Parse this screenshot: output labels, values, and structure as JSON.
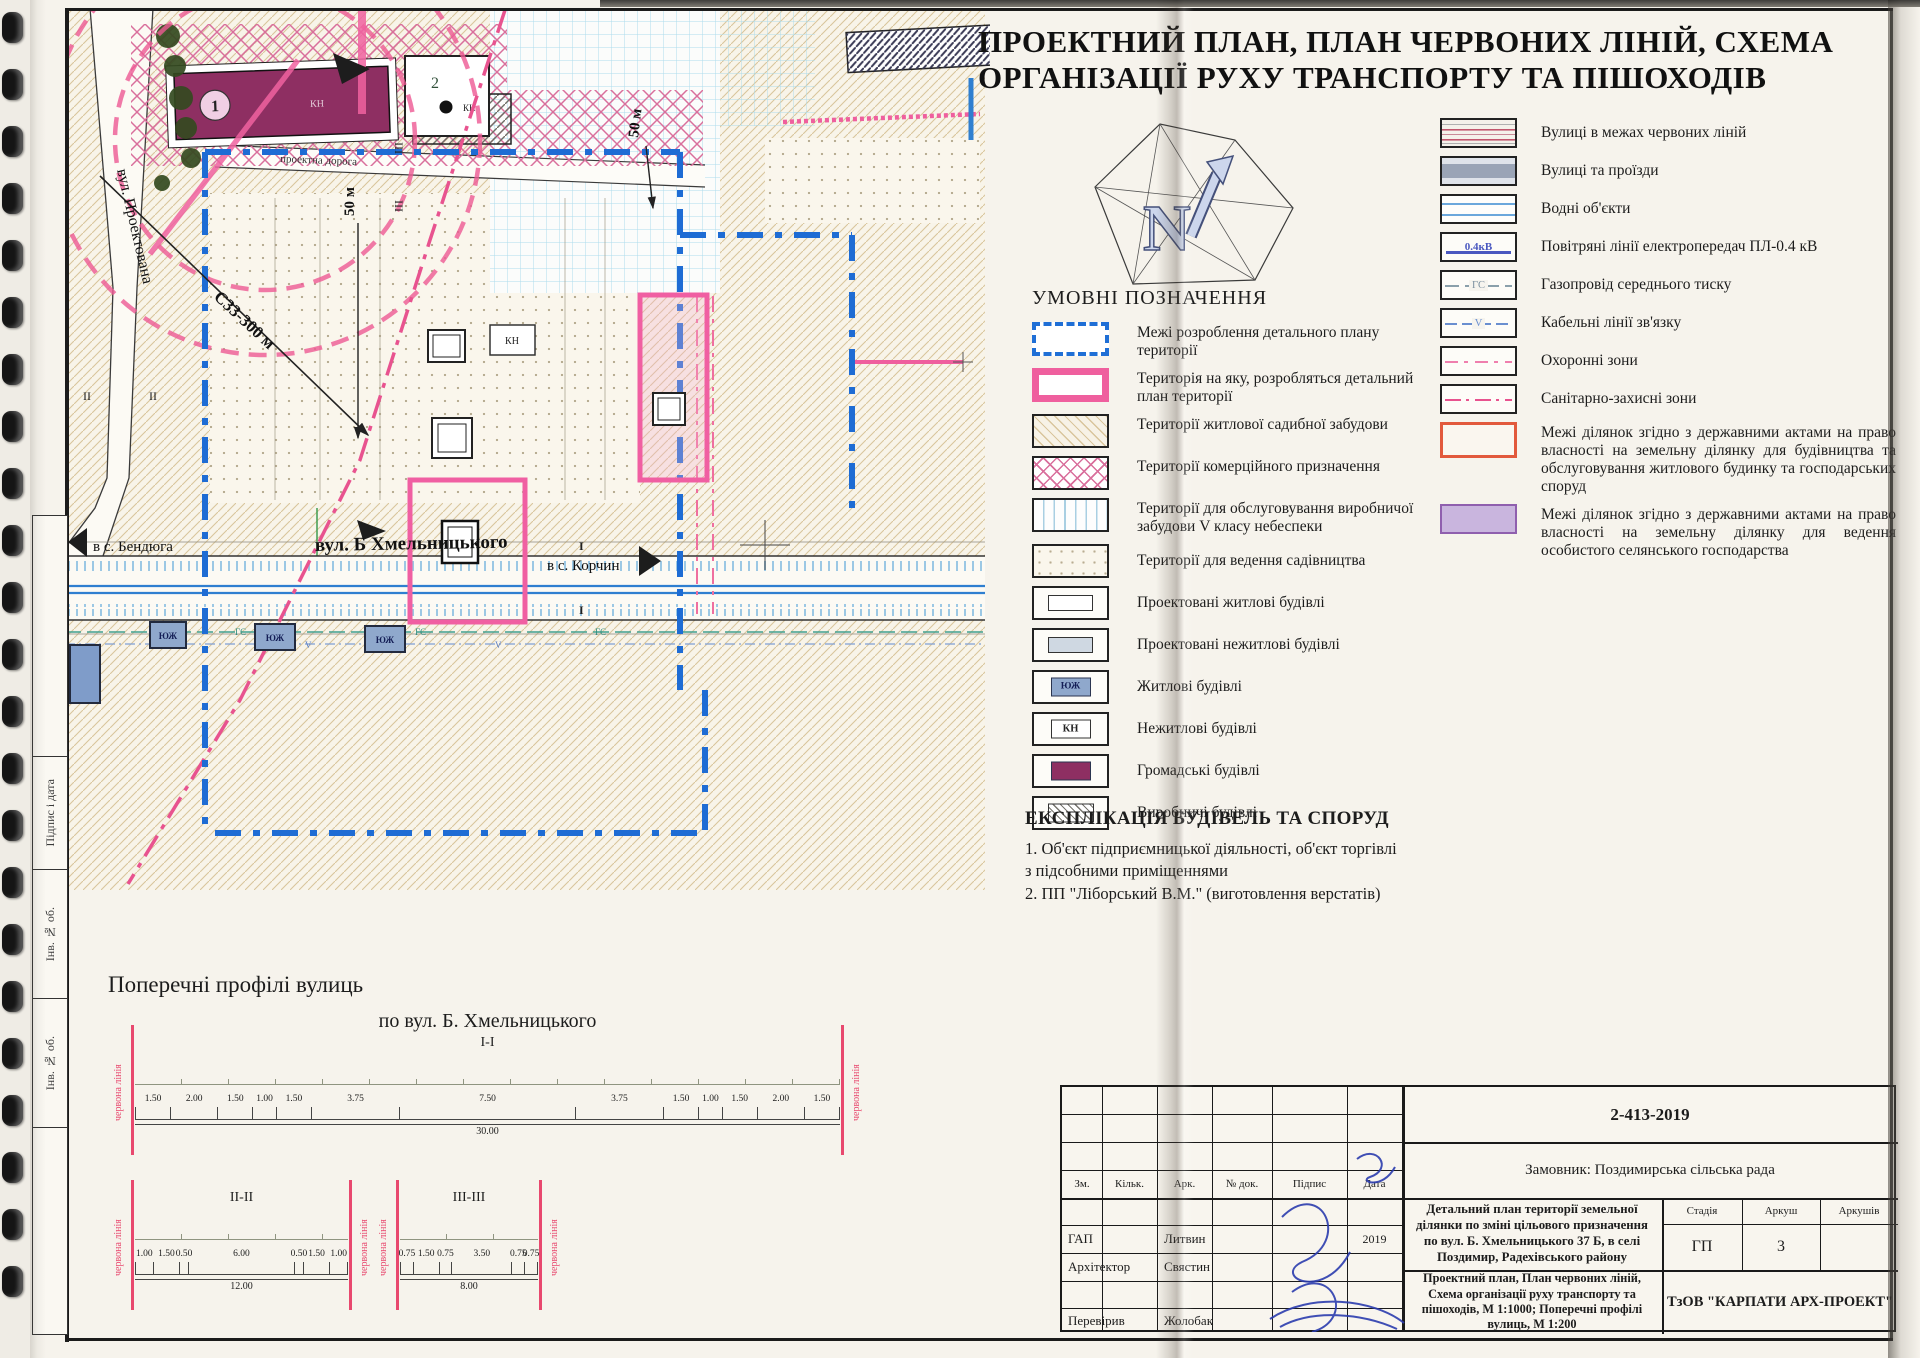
{
  "colors": {
    "boundary_blue": "#1e6cd4",
    "zone_pink": "#ee5a94",
    "public_building_magenta": "#8e2f62",
    "red_line": "#e8486e",
    "state_act_red": "#e2593c",
    "peasant_purple": "#8f5fae",
    "signature_blue": "#2b3cae"
  },
  "header": {
    "title_line1": "ПРОЕКТНИЙ ПЛАН, ПЛАН ЧЕРВОНИХ ЛІНІЙ, СХЕМА",
    "title_line2": "ОРГАНІЗАЦІЇ РУХУ ТРАНСПОРТУ ТА ПІШОХОДІВ",
    "compass_n": "N"
  },
  "map": {
    "labels": {
      "street_projected": "вул. Проектована",
      "project_road": "проектна дорога",
      "street_main": "вул. Б Хмельницького",
      "to_bendiuha": "в с. Бендюга",
      "to_korchyn": "в с. Корчин",
      "szz_dimension": "С33-300 м",
      "dist_50m": "50 м",
      "building1": "1",
      "building2": "2",
      "kn": "КН",
      "yuzh": "ЮЖ",
      "gs": "ГС",
      "v": "V",
      "sec_i": "I",
      "sec_ii": "II",
      "sec_iii": "III"
    }
  },
  "legend_left": {
    "title": "УМОВНІ ПОЗНАЧЕННЯ",
    "items": [
      {
        "label": "Межі розроблення детального плану території"
      },
      {
        "label": "Територія на яку, розробляться детальний план території"
      },
      {
        "label": "Території житлової садибної забудови"
      },
      {
        "label": "Території комерційного призначення"
      },
      {
        "label": "Території для обслуговування виробничої забудови V класу небеспеки"
      },
      {
        "label": "Території для ведення садівництва"
      },
      {
        "label": "Проектовані житлові будівлі"
      },
      {
        "label": "Проектовані нежитлові будівлі"
      },
      {
        "label": "Житлові будівлі",
        "tag": "ЮЖ"
      },
      {
        "label": "Нежитлові будівлі",
        "tag": "КН"
      },
      {
        "label": "Громадські будівлі"
      },
      {
        "label": "Виробничі будівлі"
      }
    ]
  },
  "legend_right": {
    "items": [
      {
        "label": "Вулиці в межах червоних ліній"
      },
      {
        "label": "Вулиці та проїзди"
      },
      {
        "label": "Водні об'єкти"
      },
      {
        "label": "Повітряні лінії електропередач ПЛ-0.4 кВ",
        "tag": "0.4кВ"
      },
      {
        "label": "Газопровід середнього тиску",
        "tag": "ГС"
      },
      {
        "label": "Кабельні лінії зв'язку",
        "tag": "V"
      },
      {
        "label": "Охоронні зони"
      },
      {
        "label": "Санітарно-захисні зони"
      },
      {
        "label": "Межі ділянок згідно з державними актами на право власності на земельну ділянку для будівництва та обслуговування житлового будинку та господарських споруд"
      },
      {
        "label": "Межі ділянок згідно з державними актами на право власності на земельну ділянку для ведення особистого селянського господарства"
      }
    ]
  },
  "explication": {
    "title": "ЕКСПЛІКАЦІЯ БУДІВЕЛЬ ТА СПОРУД",
    "lines": [
      "1.   Об'єкт підприємницької діяльності, об'єкт торгівлі",
      "з підсобними приміщеннями",
      "2.  ПП \"Ліборський В.М.\" (виготовлення верстатів)"
    ]
  },
  "profiles": {
    "title": "Поперечні профілі вулиць",
    "street_title": "по вул. Б. Хмельницького",
    "red_line_label": "червона лінія",
    "sections": [
      {
        "name": "I-I",
        "dims": [
          1.5,
          2.0,
          1.5,
          1.0,
          1.5,
          3.75,
          7.5,
          3.75,
          1.5,
          1.0,
          1.5,
          2.0,
          1.5
        ],
        "total": "30.00"
      },
      {
        "name": "II-II",
        "dims": [
          1.0,
          1.5,
          0.5,
          6.0,
          0.5,
          1.5,
          1.0
        ],
        "total": "12.00"
      },
      {
        "name": "III-III",
        "dims": [
          0.75,
          1.5,
          0.75,
          3.5,
          0.75,
          0.75
        ],
        "total": "8.00"
      }
    ]
  },
  "title_block": {
    "doc_number": "2-413-2019",
    "client": "Замовник: Поздимирська сільська рада",
    "cols": [
      "Зм.",
      "Кільк.",
      "Арк.",
      "№ док.",
      "Підпис",
      "Дата"
    ],
    "rows": [
      {
        "role": "ГАП",
        "name": "Литвин",
        "date": "2019"
      },
      {
        "role": "Архітектор",
        "name": "Свястин",
        "date": ""
      },
      {
        "role": "Перевірив",
        "name": "Жолобак",
        "date": ""
      }
    ],
    "project_title": "Детальний план території земельної ділянки по зміні цільового призначення по вул. Б. Хмельницького 37 Б, в селі Поздимир, Радехівського району",
    "stage_label": "Стадія",
    "sheet_label": "Аркуш",
    "sheets_label": "Аркушів",
    "stage_value": "ГП",
    "sheet_value": "3",
    "sheets_value": "",
    "scheme_title": "Проектний план, План червоних ліній, Схема організації руху транспорту та пішоходів, М 1:1000; Поперечні профілі вулиць, М 1:200",
    "company": "ТзОВ \"КАРПАТИ АРХ-ПРОЕКТ\""
  },
  "sidebar": {
    "labels": [
      "Підпис і дата",
      "Інв. № об.",
      "Інв. № об."
    ]
  }
}
